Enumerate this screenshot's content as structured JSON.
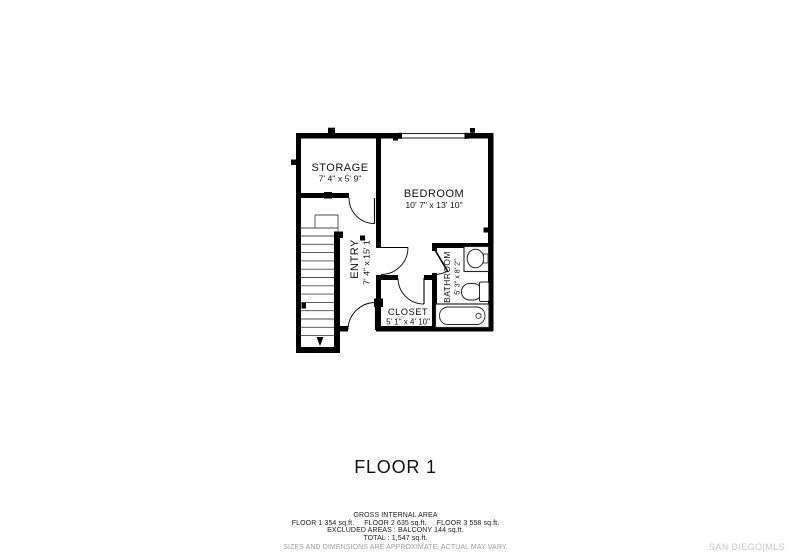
{
  "plan": {
    "floor_label": "FLOOR 1",
    "rooms": [
      {
        "name": "STORAGE",
        "dims": "7' 4\" x 5' 9\""
      },
      {
        "name": "BEDROOM",
        "dims": "10' 7\" x 13' 10\""
      },
      {
        "name": "ENTRY",
        "dims": "7' 4\" x 15' 1\""
      },
      {
        "name": "CLOSET",
        "dims": "5' 1\" x 4' 10\""
      },
      {
        "name": "BATHROOM",
        "dims": "5' 3\" x 8' 2\""
      }
    ]
  },
  "summary": {
    "heading": "GROSS INTERNAL AREA",
    "floor_areas": [
      "FLOOR 1 354 sq.ft.",
      "FLOOR 2 635 sq.ft.",
      "FLOOR 3 558 sq.ft."
    ],
    "excluded": "EXCLUDED AREAS : BALCONY 144 sq.ft.",
    "total": "TOTAL : 1,547 sq.ft.",
    "disclaimer": "SIZES AND DIMENSIONS ARE APPROXIMATE, ACTUAL MAY VARY."
  },
  "watermark": "SAN DIEGO|MLS",
  "colors": {
    "wall": "#000000",
    "tread": "#4a4a4a",
    "fixture": "#222222",
    "text": "#111111",
    "disclaimer_gray": "#9d9d9d",
    "watermark_gray": "#c7c7c7"
  }
}
